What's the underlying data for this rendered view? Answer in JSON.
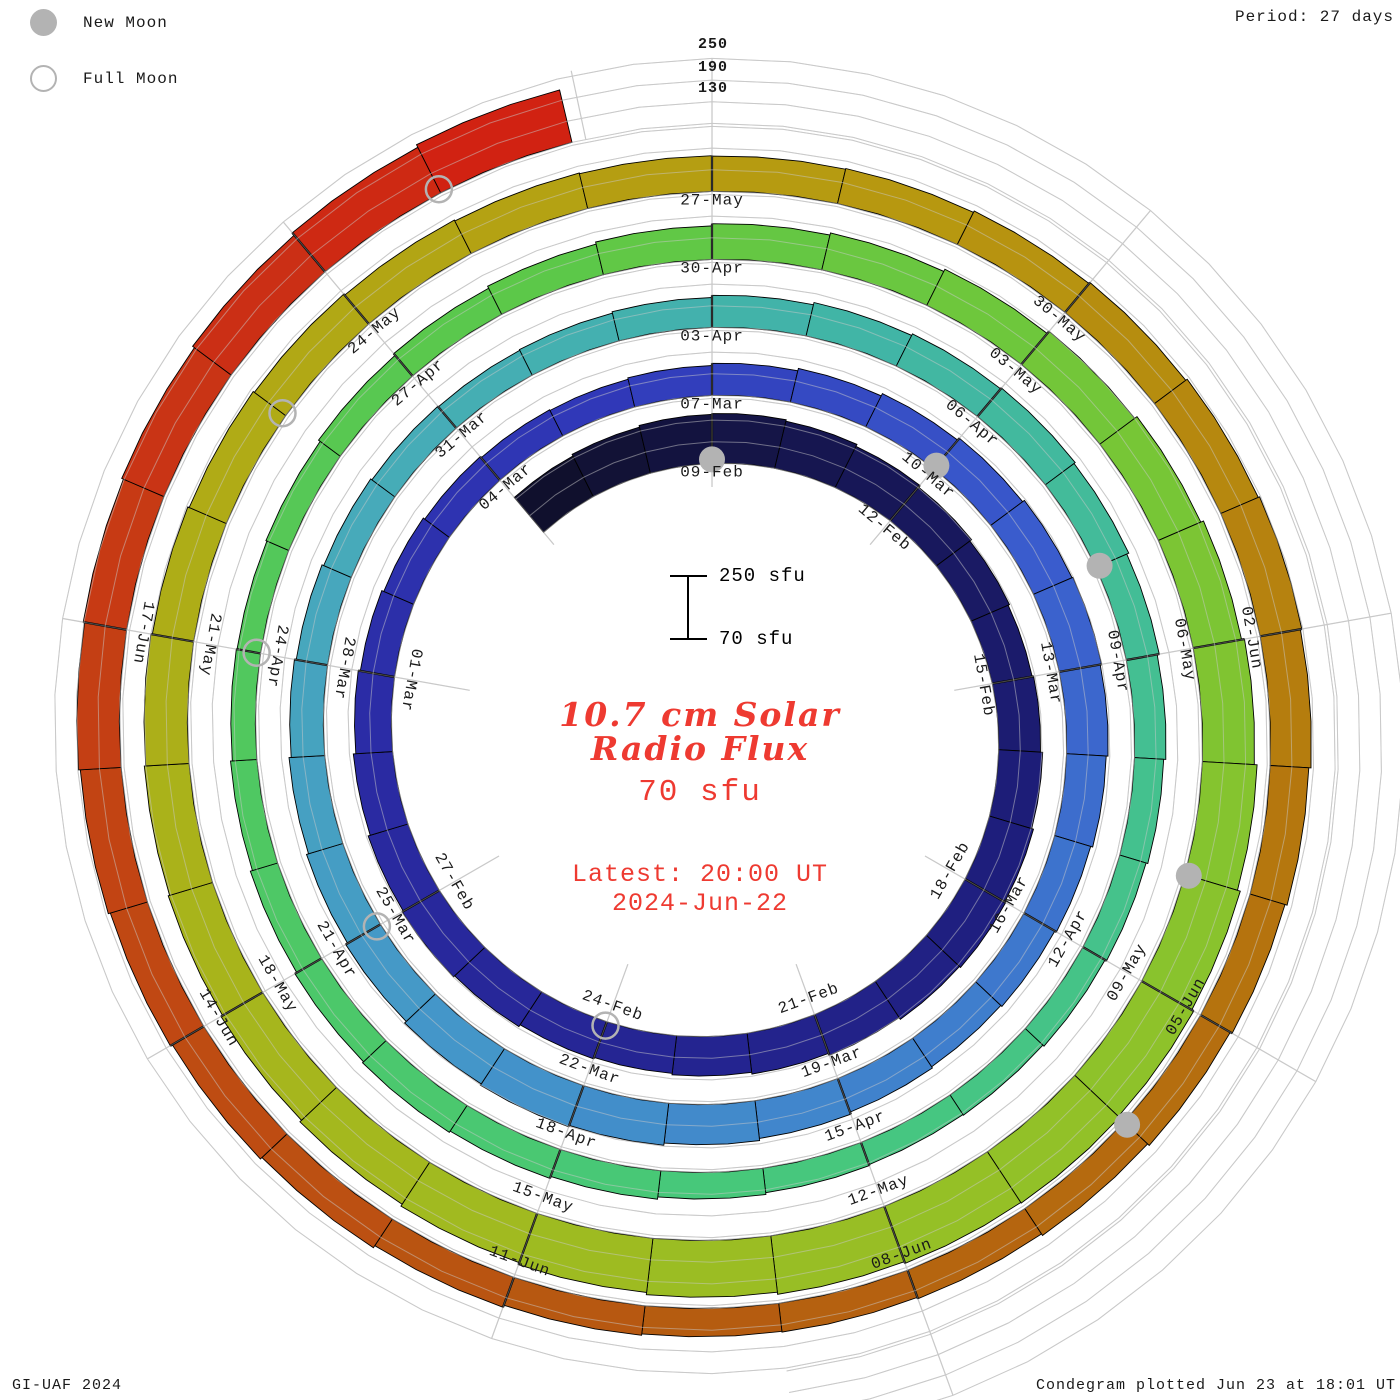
{
  "header": {
    "period_label": "Period: 27 days"
  },
  "legend": {
    "new_moon": "New Moon",
    "full_moon": "Full Moon"
  },
  "center": {
    "scale_top": "250 sfu",
    "scale_bottom": "70 sfu",
    "title_line1": "10.7 cm Solar",
    "title_line2": "Radio Flux",
    "current_value": "70 sfu",
    "latest_line1": "Latest: 20:00 UT",
    "latest_line2": "2024-Jun-22"
  },
  "footer": {
    "left": "GI-UAF 2024",
    "right": "Condegram plotted Jun 23 at 18:01 UT"
  },
  "colors": {
    "accent_red_text": "#ee3a31",
    "moon_gray": "#b3b3b3",
    "grid_gray": "#c9c9c9",
    "label_black": "#1a1a1a"
  },
  "chart_data": {
    "type": "spiral_bar_condegram",
    "title": "10.7 cm Solar Radio Flux",
    "units": "sfu",
    "period_days": 27,
    "start_date": "2024-02-06",
    "end_date": "2024-06-22",
    "value_min": 70,
    "value_max": 250,
    "gridlines_sfu": [
      70,
      130,
      190,
      250
    ],
    "radial_tick_labels": [
      "250",
      "190",
      "130"
    ],
    "spoke_step_days": 3,
    "daily_flux_sfu": [
      196,
      201,
      206,
      208,
      204,
      198,
      192,
      186,
      182,
      186,
      192,
      197,
      200,
      196,
      190,
      184,
      179,
      175,
      179,
      185,
      189,
      185,
      179,
      172,
      166,
      160,
      155,
      151,
      149,
      153,
      159,
      166,
      173,
      180,
      186,
      189,
      185,
      180,
      174,
      169,
      165,
      169,
      175,
      181,
      187,
      191,
      187,
      181,
      175,
      169,
      163,
      158,
      153,
      149,
      147,
      149,
      153,
      159,
      165,
      170,
      173,
      169,
      163,
      157,
      151,
      146,
      141,
      137,
      135,
      138,
      143,
      149,
      155,
      159,
      155,
      149,
      143,
      138,
      136,
      139,
      145,
      151,
      157,
      163,
      169,
      175,
      182,
      190,
      198,
      206,
      214,
      222,
      230,
      236,
      240,
      238,
      233,
      227,
      221,
      215,
      209,
      203,
      198,
      194,
      190,
      186,
      182,
      178,
      174,
      171,
      169,
      168,
      170,
      174,
      178,
      183,
      187,
      183,
      177,
      171,
      165,
      159,
      154,
      150,
      148,
      152,
      158,
      165,
      171,
      177,
      183,
      188,
      192,
      197,
      203,
      211,
      219,
      227
    ],
    "date_labels": [
      {
        "day": 3,
        "label": "09-Feb"
      },
      {
        "day": 6,
        "label": "12-Feb"
      },
      {
        "day": 9,
        "label": "15-Feb"
      },
      {
        "day": 12,
        "label": "18-Feb"
      },
      {
        "day": 15,
        "label": "21-Feb"
      },
      {
        "day": 18,
        "label": "24-Feb"
      },
      {
        "day": 21,
        "label": "27-Feb"
      },
      {
        "day": 24,
        "label": "01-Mar"
      },
      {
        "day": 27,
        "label": "04-Mar"
      },
      {
        "day": 30,
        "label": "07-Mar"
      },
      {
        "day": 33,
        "label": "10-Mar"
      },
      {
        "day": 36,
        "label": "13-Mar"
      },
      {
        "day": 39,
        "label": "16-Mar"
      },
      {
        "day": 42,
        "label": "19-Mar"
      },
      {
        "day": 45,
        "label": "22-Mar"
      },
      {
        "day": 48,
        "label": "25-Mar"
      },
      {
        "day": 51,
        "label": "28-Mar"
      },
      {
        "day": 54,
        "label": "31-Mar"
      },
      {
        "day": 57,
        "label": "03-Apr"
      },
      {
        "day": 60,
        "label": "06-Apr"
      },
      {
        "day": 63,
        "label": "09-Apr"
      },
      {
        "day": 66,
        "label": "12-Apr"
      },
      {
        "day": 69,
        "label": "15-Apr"
      },
      {
        "day": 72,
        "label": "18-Apr"
      },
      {
        "day": 75,
        "label": "21-Apr"
      },
      {
        "day": 78,
        "label": "24-Apr"
      },
      {
        "day": 81,
        "label": "27-Apr"
      },
      {
        "day": 84,
        "label": "30-Apr"
      },
      {
        "day": 87,
        "label": "03-May"
      },
      {
        "day": 90,
        "label": "06-May"
      },
      {
        "day": 93,
        "label": "09-May"
      },
      {
        "day": 96,
        "label": "12-May"
      },
      {
        "day": 99,
        "label": "15-May"
      },
      {
        "day": 102,
        "label": "18-May"
      },
      {
        "day": 105,
        "label": "21-May"
      },
      {
        "day": 108,
        "label": "24-May"
      },
      {
        "day": 111,
        "label": "27-May"
      },
      {
        "day": 114,
        "label": "30-May"
      },
      {
        "day": 117,
        "label": "02-Jun"
      },
      {
        "day": 120,
        "label": "05-Jun"
      },
      {
        "day": 123,
        "label": "08-Jun"
      },
      {
        "day": 126,
        "label": "11-Jun"
      },
      {
        "day": 129,
        "label": "14-Jun"
      },
      {
        "day": 132,
        "label": "17-Jun"
      }
    ],
    "moons": {
      "new": [
        {
          "day": 3,
          "date": "2024-02-09"
        },
        {
          "day": 33,
          "date": "2024-03-10"
        },
        {
          "day": 62,
          "date": "2024-04-08"
        },
        {
          "day": 92,
          "date": "2024-05-08"
        },
        {
          "day": 121,
          "date": "2024-06-06"
        }
      ],
      "full": [
        {
          "day": 18,
          "date": "2024-02-24"
        },
        {
          "day": 48,
          "date": "2024-03-25"
        },
        {
          "day": 78,
          "date": "2024-04-24"
        },
        {
          "day": 107,
          "date": "2024-05-23"
        },
        {
          "day": 136,
          "date": "2024-06-21"
        }
      ]
    },
    "colormap_stops": [
      {
        "day": 0,
        "color": "#10102d"
      },
      {
        "day": 4,
        "color": "#161650"
      },
      {
        "day": 10,
        "color": "#1d1d78"
      },
      {
        "day": 16,
        "color": "#242490"
      },
      {
        "day": 22,
        "color": "#2a2aa2"
      },
      {
        "day": 28,
        "color": "#3038b8"
      },
      {
        "day": 34,
        "color": "#3a5ccd"
      },
      {
        "day": 40,
        "color": "#3f7ecd"
      },
      {
        "day": 46,
        "color": "#4496c9"
      },
      {
        "day": 52,
        "color": "#47aaba"
      },
      {
        "day": 58,
        "color": "#41b5a6"
      },
      {
        "day": 64,
        "color": "#44c18e"
      },
      {
        "day": 70,
        "color": "#47c87a"
      },
      {
        "day": 76,
        "color": "#4fc862"
      },
      {
        "day": 82,
        "color": "#5cc849"
      },
      {
        "day": 88,
        "color": "#77c636"
      },
      {
        "day": 94,
        "color": "#92c128"
      },
      {
        "day": 100,
        "color": "#a4b81e"
      },
      {
        "day": 106,
        "color": "#b0ab16"
      },
      {
        "day": 112,
        "color": "#b79810"
      },
      {
        "day": 118,
        "color": "#b5770e"
      },
      {
        "day": 124,
        "color": "#b55c10"
      },
      {
        "day": 130,
        "color": "#c24413"
      },
      {
        "day": 134,
        "color": "#cb2f15"
      },
      {
        "day": 137,
        "color": "#d41c10"
      }
    ],
    "geometry": {
      "cx": 712,
      "cy": 733,
      "r_base_day0": 262,
      "radius_per_turn": 68,
      "px_per_sfu": 0.3611,
      "spoke_inner_r": 246,
      "grid_extend_days": 14,
      "moon_radius": 13,
      "label_inset": 13
    },
    "legend_position": "top-left",
    "grid": true
  }
}
